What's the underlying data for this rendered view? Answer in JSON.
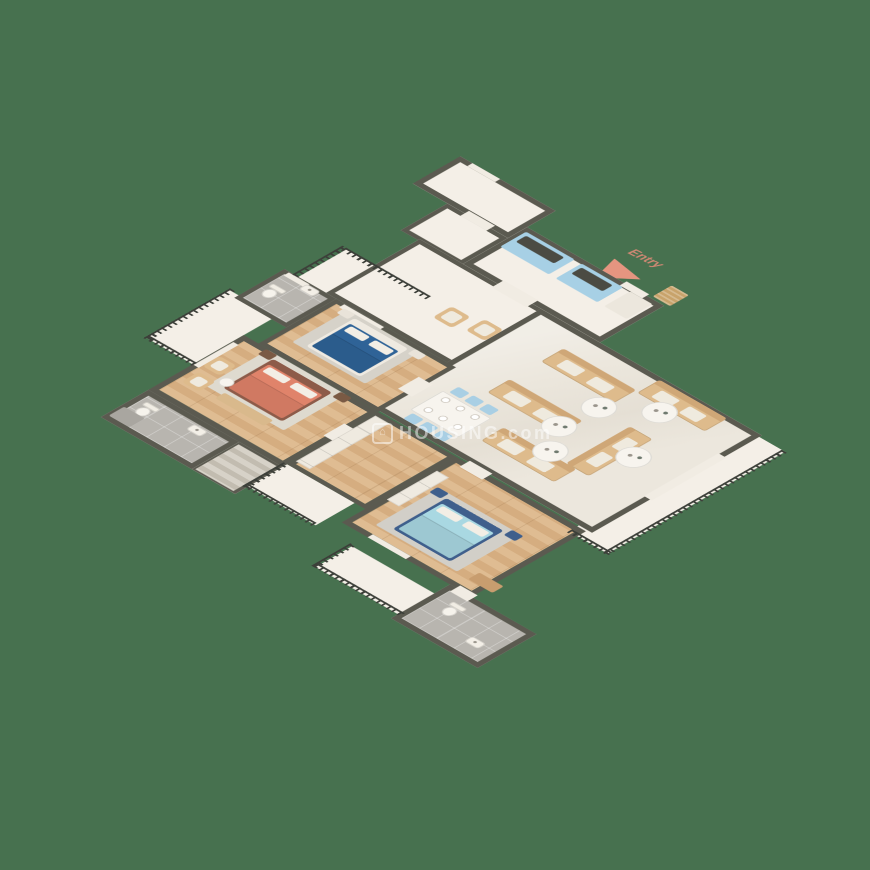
{
  "watermark": {
    "logo_glyph": "⌂",
    "text": "HOUSING.com"
  },
  "entry": {
    "label": "Entry"
  },
  "palette": {
    "bg": "#47714f",
    "wall": "#5b5a50",
    "cream": "#f4efe7",
    "marble": "#ece7dd",
    "tile": "#b8b5af",
    "woodA": "#dfbc92",
    "woodB": "#d5ad80",
    "railing": "#3c3f39",
    "sofa": "#debb8c",
    "sofaBack": "#cfa777",
    "cushion": "#efeade",
    "tableWhite": "#f7f4ee",
    "cabBlue": "#a7d0e5",
    "counter": "#4b4b43",
    "pillow": "#f3eee5",
    "chairBlue": "#a9cfe4",
    "rug": "#d8d4cc",
    "matTan": "#c8a36b",
    "openWhite": "#f1ece3",
    "arrow": "#e59580",
    "entryText": "#cf8873",
    "wm": "rgba(255,255,255,0.5)"
  },
  "scene": {
    "rooms": [
      {
        "id": "balcony-master",
        "x": 0,
        "y": 268,
        "w": 55,
        "h": 96,
        "floor": "cream",
        "wt": 0
      },
      {
        "id": "balcony-2",
        "x": 28,
        "y": 160,
        "w": 96,
        "h": 55,
        "floor": "cream",
        "wt": 0
      },
      {
        "id": "balcony-3",
        "x": 210,
        "y": 410,
        "w": 78,
        "h": 45,
        "floor": "cream",
        "wt": 0
      },
      {
        "id": "balcony-4",
        "x": 330,
        "y": 455,
        "w": 98,
        "h": 42,
        "floor": "cream",
        "wt": 0
      },
      {
        "id": "terrace",
        "x": 440,
        "y": 110,
        "w": 45,
        "h": 205,
        "floor": "cream",
        "wt": 0
      },
      {
        "id": "foyer",
        "x": 0,
        "y": 0,
        "w": 110,
        "h": 55,
        "floor": "cream",
        "wt": 6
      },
      {
        "id": "entry-corridor",
        "x": 40,
        "y": 55,
        "w": 70,
        "h": 54,
        "floor": "cream",
        "wt": 5
      },
      {
        "id": "kitchen",
        "x": 110,
        "y": 33,
        "w": 158,
        "h": 74,
        "floor": "cream",
        "wt": 6
      },
      {
        "id": "hall",
        "x": 60,
        "y": 107,
        "w": 200,
        "h": 108,
        "floor": "cream",
        "wt": 5
      },
      {
        "id": "living-dining",
        "x": 200,
        "y": 107,
        "w": 255,
        "h": 196,
        "floor": "marble",
        "wt": 6
      },
      {
        "id": "bathroom-2",
        "x": 12,
        "y": 215,
        "w": 60,
        "h": 58,
        "floor": "tile",
        "wt": 5
      },
      {
        "id": "bedroom-2",
        "x": 72,
        "y": 215,
        "w": 138,
        "h": 90,
        "floor": "wood",
        "wt": 5
      },
      {
        "id": "master-bedroom",
        "x": 55,
        "y": 305,
        "w": 155,
        "h": 110,
        "floor": "wood",
        "wt": 6
      },
      {
        "id": "master-bathroom",
        "x": 55,
        "y": 415,
        "w": 105,
        "h": 55,
        "floor": "tile",
        "wt": 6
      },
      {
        "id": "stairs-nook",
        "x": 160,
        "y": 415,
        "w": 50,
        "h": 55,
        "floor": "cream",
        "wt": 5
      },
      {
        "id": "dressing",
        "x": 210,
        "y": 305,
        "w": 90,
        "h": 105,
        "floor": "wood",
        "wt": 5
      },
      {
        "id": "bedroom-3",
        "x": 300,
        "y": 305,
        "w": 150,
        "h": 132,
        "floor": "wood",
        "wt": 6
      },
      {
        "id": "bathroom-3",
        "x": 425,
        "y": 437,
        "w": 100,
        "h": 68,
        "floor": "tile",
        "wt": 6
      }
    ],
    "items": [
      {
        "t": "open",
        "n": "entry-door-opening",
        "x": 222,
        "y": 30,
        "w": 26,
        "h": 8
      },
      {
        "t": "open",
        "n": "kitchen-hall-opening",
        "x": 150,
        "y": 100,
        "w": 40,
        "h": 14
      },
      {
        "t": "open",
        "n": "foyer-corridor-opening",
        "x": 60,
        "y": 50,
        "w": 30,
        "h": 10
      },
      {
        "t": "open",
        "n": "bedroom2-door-opening",
        "x": 198,
        "y": 246,
        "w": 16,
        "h": 24
      },
      {
        "t": "open",
        "n": "master-door-opening",
        "x": 202,
        "y": 336,
        "w": 14,
        "h": 24
      },
      {
        "t": "open",
        "n": "bedroom3-door-opening",
        "x": 312,
        "y": 301,
        "w": 26,
        "h": 12
      },
      {
        "t": "open",
        "n": "bathroom3-door-opening",
        "x": 432,
        "y": 432,
        "w": 20,
        "h": 12
      },
      {
        "t": "open",
        "n": "window",
        "x": 14,
        "y": 0,
        "w": 32,
        "h": 6
      },
      {
        "t": "open",
        "n": "window",
        "x": 82,
        "y": 216,
        "w": 46,
        "h": 6
      },
      {
        "t": "open",
        "n": "window",
        "x": 56,
        "y": 318,
        "w": 6,
        "h": 46
      },
      {
        "t": "open",
        "n": "window",
        "x": 330,
        "y": 431,
        "w": 44,
        "h": 6
      },
      {
        "t": "open",
        "n": "terrace-slider",
        "x": 448,
        "y": 150,
        "w": 9,
        "h": 86
      },
      {
        "t": "open",
        "n": "window",
        "x": 18,
        "y": 216,
        "w": 24,
        "h": 6
      },
      {
        "t": "rug",
        "x": 84,
        "y": 306,
        "w": 90,
        "h": 72,
        "c": "#dedacf"
      },
      {
        "t": "rug",
        "x": 90,
        "y": 220,
        "w": 84,
        "h": 64,
        "c": "#d6d2c9"
      },
      {
        "t": "rug",
        "x": 322,
        "y": 346,
        "w": 94,
        "h": 74,
        "c": "#d2cfc8"
      },
      {
        "t": "bed",
        "n": "master-bed",
        "x": 96,
        "y": 312,
        "w": 68,
        "h": 58,
        "fr": "#8d5b49",
        "m": "#e0836a"
      },
      {
        "t": "bed",
        "n": "bedroom2-bed",
        "x": 102,
        "y": 224,
        "w": 62,
        "h": 56,
        "fr": "#efeae1",
        "m": "#2f6397"
      },
      {
        "t": "bed",
        "n": "bedroom3-bed",
        "x": 336,
        "y": 352,
        "w": 66,
        "h": 62,
        "fr": "#3f5f8c",
        "m": "#a9d8e2"
      },
      {
        "t": "rect",
        "n": "nightstand",
        "x": 82,
        "y": 306,
        "w": 13,
        "h": 10,
        "c": "#7a5a44"
      },
      {
        "t": "rect",
        "n": "nightstand",
        "x": 168,
        "y": 306,
        "w": 13,
        "h": 10,
        "c": "#7a5a44"
      },
      {
        "t": "rect",
        "n": "nightstand",
        "x": 86,
        "y": 220,
        "w": 13,
        "h": 9,
        "c": "#e9e3d9"
      },
      {
        "t": "rect",
        "n": "nightstand",
        "x": 168,
        "y": 220,
        "w": 13,
        "h": 9,
        "c": "#e9e3d9"
      },
      {
        "t": "rect",
        "n": "nightstand",
        "x": 320,
        "y": 346,
        "w": 13,
        "h": 10,
        "c": "#3f5f8c"
      },
      {
        "t": "rect",
        "n": "nightstand",
        "x": 406,
        "y": 346,
        "w": 13,
        "h": 10,
        "c": "#3f5f8c"
      },
      {
        "t": "chair",
        "n": "master-armchair",
        "x": 62,
        "y": 340,
        "w": 20,
        "h": 20
      },
      {
        "t": "chair",
        "n": "master-armchair",
        "x": 66,
        "y": 368,
        "w": 20,
        "h": 20
      },
      {
        "t": "tbl",
        "n": "side-table",
        "x": 86,
        "y": 356,
        "w": 13,
        "h": 13
      },
      {
        "t": "rect",
        "n": "bench",
        "x": 102,
        "y": 374,
        "w": 56,
        "h": 11,
        "c": "#d9b98c"
      },
      {
        "t": "chair",
        "n": "hall-armchair",
        "x": 146,
        "y": 156,
        "w": 22,
        "h": 22
      },
      {
        "t": "chair",
        "n": "hall-armchair",
        "x": 178,
        "y": 150,
        "w": 22,
        "h": 22
      },
      {
        "t": "kcab",
        "x": 114,
        "y": 38,
        "w": 56,
        "h": 30
      },
      {
        "t": "kcab",
        "x": 178,
        "y": 38,
        "w": 48,
        "h": 30
      },
      {
        "t": "rect",
        "n": "kitchen-unit",
        "x": 234,
        "y": 38,
        "w": 26,
        "h": 30,
        "c": "#ece7dd"
      },
      {
        "t": "mat",
        "x": 252,
        "y": 8,
        "w": 20,
        "h": 22
      },
      {
        "t": "dine",
        "x": 226,
        "y": 233,
        "w": 56,
        "h": 64
      },
      {
        "t": "sofa",
        "x": 253,
        "y": 134,
        "w": 84,
        "h": 26
      },
      {
        "t": "sofa",
        "x": 253,
        "y": 196,
        "w": 84,
        "h": 26
      },
      {
        "t": "sofa",
        "x": 340,
        "y": 110,
        "w": 78,
        "h": 26
      },
      {
        "t": "sofa",
        "x": 298,
        "y": 248,
        "w": 84,
        "h": 26
      },
      {
        "t": "sofa",
        "x": 370,
        "y": 174,
        "w": 26,
        "h": 74
      },
      {
        "t": "tbl",
        "n": "coffee-table",
        "x": 318,
        "y": 158,
        "w": 30,
        "h": 30
      },
      {
        "t": "tbl",
        "n": "coffee-table",
        "x": 358,
        "y": 128,
        "w": 30,
        "h": 30
      },
      {
        "t": "tbl",
        "n": "coffee-table",
        "x": 314,
        "y": 200,
        "w": 30,
        "h": 30
      },
      {
        "t": "tbl",
        "n": "coffee-table",
        "x": 334,
        "y": 230,
        "w": 30,
        "h": 30
      },
      {
        "t": "tbl",
        "n": "coffee-table",
        "x": 388,
        "y": 188,
        "w": 30,
        "h": 30
      },
      {
        "t": "toilet",
        "x": 20,
        "y": 236,
        "w": 16,
        "h": 20
      },
      {
        "t": "toilet",
        "x": 66,
        "y": 428,
        "w": 16,
        "h": 20
      },
      {
        "t": "toilet",
        "x": 444,
        "y": 452,
        "w": 16,
        "h": 20
      },
      {
        "t": "sink",
        "x": 40,
        "y": 217,
        "w": 16,
        "h": 10
      },
      {
        "t": "sink",
        "x": 116,
        "y": 423,
        "w": 16,
        "h": 10
      },
      {
        "t": "sink",
        "x": 490,
        "y": 476,
        "w": 16,
        "h": 10
      },
      {
        "t": "rect",
        "n": "shower",
        "x": 58,
        "y": 446,
        "w": 24,
        "h": 18,
        "c": "#a9a6a0"
      },
      {
        "t": "stairs",
        "x": 162,
        "y": 418,
        "w": 44,
        "h": 50
      },
      {
        "t": "ward",
        "x": 212,
        "y": 310,
        "w": 16,
        "h": 92
      },
      {
        "t": "ward",
        "x": 303,
        "y": 330,
        "w": 14,
        "h": 58
      },
      {
        "t": "rect",
        "n": "desk",
        "x": 430,
        "y": 408,
        "w": 28,
        "h": 13,
        "c": "#c89d6f"
      },
      {
        "t": "rail",
        "x": 0,
        "y": 266,
        "w": 6,
        "h": 98
      },
      {
        "t": "rail",
        "x": 0,
        "y": 360,
        "w": 56,
        "h": 6
      },
      {
        "t": "rail",
        "x": 26,
        "y": 158,
        "w": 98,
        "h": 6
      },
      {
        "t": "rail",
        "x": 22,
        "y": 158,
        "w": 6,
        "h": 58
      },
      {
        "t": "rail",
        "x": 206,
        "y": 410,
        "w": 6,
        "h": 47
      },
      {
        "t": "rail",
        "x": 206,
        "y": 452,
        "w": 80,
        "h": 6
      },
      {
        "t": "rail",
        "x": 326,
        "y": 453,
        "w": 6,
        "h": 45
      },
      {
        "t": "rail",
        "x": 328,
        "y": 492,
        "w": 100,
        "h": 6
      },
      {
        "t": "rail",
        "x": 481,
        "y": 110,
        "w": 6,
        "h": 206
      },
      {
        "t": "rail",
        "x": 440,
        "y": 311,
        "w": 46,
        "h": 6
      }
    ]
  }
}
